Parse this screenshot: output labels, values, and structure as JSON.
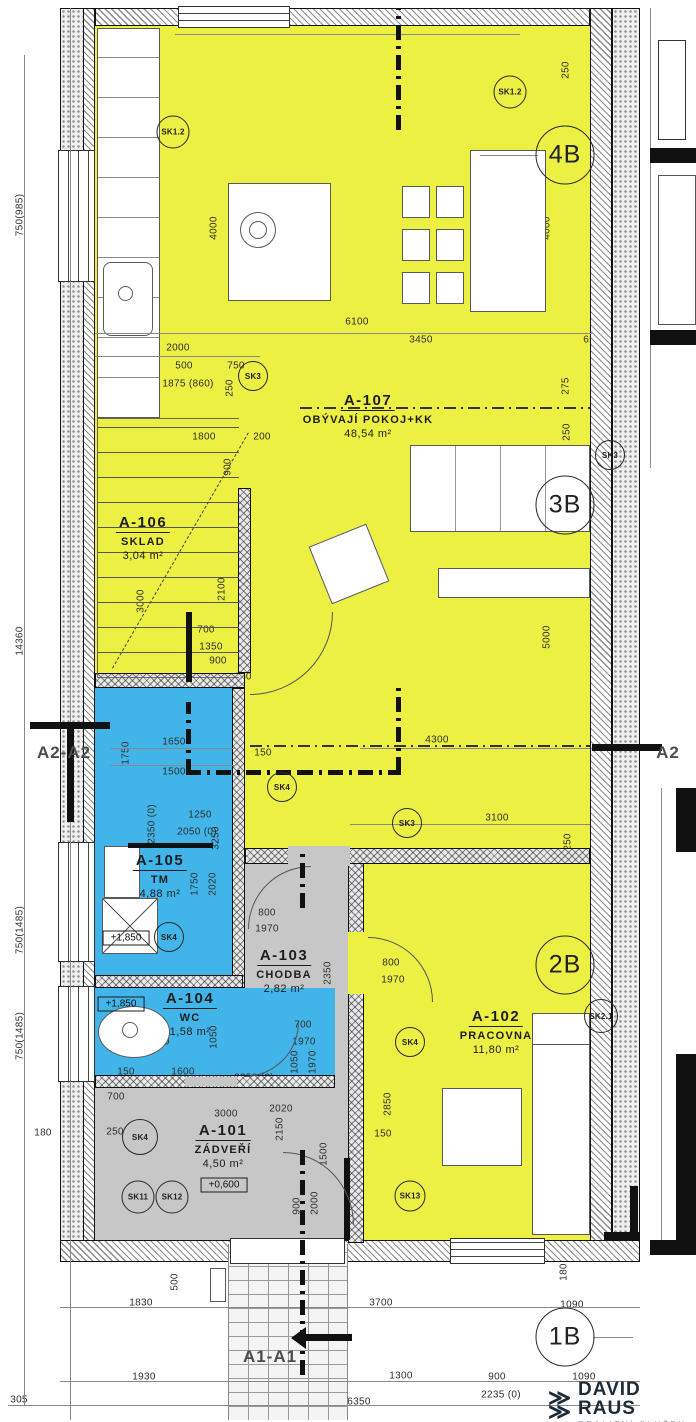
{
  "palette": {
    "room_yellow": "#ebf043",
    "room_blue": "#41b4e9",
    "room_gray": "#c7c7c7",
    "wall_dark": "#111111",
    "dim_text": "#2e2e2e",
    "logo_dark": "#1d2b36",
    "logo_gray": "#93a1ab"
  },
  "rooms": [
    {
      "code": "A-107",
      "name": "OBÝVAJÍ POKOJ+KK",
      "area": "48,54 m²",
      "x": 368,
      "y": 392
    },
    {
      "code": "A-106",
      "name": "SKLAD",
      "area": "3,04 m²",
      "x": 143,
      "y": 514
    },
    {
      "code": "A-105",
      "name": "TM",
      "area": "4,88 m²",
      "x": 160,
      "y": 852
    },
    {
      "code": "A-104",
      "name": "WC",
      "area": "1,58 m²",
      "x": 190,
      "y": 990
    },
    {
      "code": "A-103",
      "name": "CHODBA",
      "area": "2,82 m²",
      "x": 284,
      "y": 947
    },
    {
      "code": "A-102",
      "name": "PRACOVNA",
      "area": "11,80 m²",
      "x": 496,
      "y": 1008
    },
    {
      "code": "A-101",
      "name": "ZÁDVEŘÍ",
      "area": "4,50 m²",
      "x": 223,
      "y": 1122
    }
  ],
  "unit_markers": [
    {
      "label": "4B",
      "x": 565,
      "y": 155
    },
    {
      "label": "3B",
      "x": 565,
      "y": 505
    },
    {
      "label": "2B",
      "x": 565,
      "y": 965
    },
    {
      "label": "1B",
      "x": 565,
      "y": 1337
    }
  ],
  "sk_markers": [
    {
      "label": "SK1.2",
      "x": 173,
      "y": 132,
      "d": 31
    },
    {
      "label": "SK1.2",
      "x": 510,
      "y": 92,
      "d": 31
    },
    {
      "label": "SK3",
      "x": 253,
      "y": 376,
      "d": 28
    },
    {
      "label": "SK3",
      "x": 610,
      "y": 455,
      "d": 28
    },
    {
      "label": "SK3",
      "x": 407,
      "y": 823,
      "d": 28
    },
    {
      "label": "SK4",
      "x": 282,
      "y": 787,
      "d": 28
    },
    {
      "label": "SK4",
      "x": 169,
      "y": 937,
      "d": 28
    },
    {
      "label": "SK4",
      "x": 410,
      "y": 1042,
      "d": 28
    },
    {
      "label": "SK4",
      "x": 140,
      "y": 1137,
      "d": 34
    },
    {
      "label": "SK11",
      "x": 138,
      "y": 1197,
      "d": 31
    },
    {
      "label": "SK12",
      "x": 172,
      "y": 1197,
      "d": 31
    },
    {
      "label": "SK13",
      "x": 410,
      "y": 1196,
      "d": 29
    },
    {
      "label": "SK2.1",
      "x": 601,
      "y": 1016,
      "d": 32
    }
  ],
  "elevations": [
    {
      "text": "+1,850",
      "x": 126,
      "y": 938
    },
    {
      "text": "+1,850",
      "x": 121,
      "y": 1004
    },
    {
      "text": "+0,600",
      "x": 224,
      "y": 1185
    }
  ],
  "sections": [
    {
      "text": "A2-A2",
      "x": 64,
      "y": 753
    },
    {
      "text": "A2",
      "x": 668,
      "y": 753
    },
    {
      "text": "A1-A1",
      "x": 270,
      "y": 1357
    }
  ],
  "logo": {
    "glyph": "≫",
    "name": "DAVID RAUS",
    "subtitle": "REALITNÍ SLUŽBY"
  },
  "dimensions": [
    {
      "t": "250",
      "x": 566,
      "y": 70,
      "r": 90
    },
    {
      "t": "1400 (600)",
      "x": 112,
      "y": 163,
      "r": 90
    },
    {
      "t": "4000",
      "x": 214,
      "y": 228,
      "r": 90
    },
    {
      "t": "4000",
      "x": 547,
      "y": 228,
      "r": 90
    },
    {
      "t": "6100",
      "x": 357,
      "y": 322,
      "r": 0
    },
    {
      "t": "2000",
      "x": 178,
      "y": 348,
      "r": 0
    },
    {
      "t": "750",
      "x": 122,
      "y": 366,
      "r": 0
    },
    {
      "t": "500",
      "x": 184,
      "y": 366,
      "r": 0
    },
    {
      "t": "750",
      "x": 236,
      "y": 366,
      "r": 0
    },
    {
      "t": "1875 (860)",
      "x": 188,
      "y": 384,
      "r": 0
    },
    {
      "t": "250",
      "x": 230,
      "y": 388,
      "r": 90
    },
    {
      "t": "3450",
      "x": 421,
      "y": 340,
      "r": 0
    },
    {
      "t": "650",
      "x": 592,
      "y": 340,
      "r": 0
    },
    {
      "t": "425",
      "x": 608,
      "y": 358,
      "r": 0
    },
    {
      "t": "275",
      "x": 566,
      "y": 386,
      "r": 90
    },
    {
      "t": "250",
      "x": 567,
      "y": 432,
      "r": 90
    },
    {
      "t": "1800",
      "x": 204,
      "y": 437,
      "r": 0
    },
    {
      "t": "200",
      "x": 262,
      "y": 437,
      "r": 0
    },
    {
      "t": "900",
      "x": 228,
      "y": 467,
      "r": 90
    },
    {
      "t": "3000",
      "x": 141,
      "y": 601,
      "r": 90
    },
    {
      "t": "2100",
      "x": 222,
      "y": 589,
      "r": 90
    },
    {
      "t": "700",
      "x": 206,
      "y": 630,
      "r": 0
    },
    {
      "t": "1350",
      "x": 211,
      "y": 647,
      "r": 0
    },
    {
      "t": "900",
      "x": 218,
      "y": 661,
      "r": 0
    },
    {
      "t": "750",
      "x": 130,
      "y": 683,
      "r": 0
    },
    {
      "t": "150",
      "x": 243,
      "y": 677,
      "r": 0
    },
    {
      "t": "5000",
      "x": 547,
      "y": 637,
      "r": 90
    },
    {
      "t": "4300",
      "x": 437,
      "y": 740,
      "r": 0
    },
    {
      "t": "150",
      "x": 263,
      "y": 753,
      "r": 0
    },
    {
      "t": "250",
      "x": 601,
      "y": 753,
      "r": 0
    },
    {
      "t": "20",
      "x": 631,
      "y": 757,
      "r": 0
    },
    {
      "t": "1650",
      "x": 174,
      "y": 742,
      "r": 0
    },
    {
      "t": "1500",
      "x": 174,
      "y": 772,
      "r": 0
    },
    {
      "t": "1750",
      "x": 126,
      "y": 753,
      "r": 90
    },
    {
      "t": "1250",
      "x": 200,
      "y": 815,
      "r": 0
    },
    {
      "t": "2050 (0)",
      "x": 197,
      "y": 832,
      "r": 0
    },
    {
      "t": "3100",
      "x": 497,
      "y": 818,
      "r": 0
    },
    {
      "t": "250",
      "x": 568,
      "y": 842,
      "r": 90
    },
    {
      "t": "2350 (0)",
      "x": 152,
      "y": 824,
      "r": 90
    },
    {
      "t": "3250",
      "x": 216,
      "y": 838,
      "r": 90
    },
    {
      "t": "1750",
      "x": 195,
      "y": 884,
      "r": 90
    },
    {
      "t": "2020",
      "x": 213,
      "y": 884,
      "r": 90
    },
    {
      "t": "1500",
      "x": 129,
      "y": 908,
      "r": 90
    },
    {
      "t": "800",
      "x": 267,
      "y": 913,
      "r": 0
    },
    {
      "t": "1970",
      "x": 267,
      "y": 929,
      "r": 0
    },
    {
      "t": "2350",
      "x": 328,
      "y": 973,
      "r": 90
    },
    {
      "t": "800",
      "x": 391,
      "y": 963,
      "r": 0
    },
    {
      "t": "1970",
      "x": 393,
      "y": 980,
      "r": 0
    },
    {
      "t": "700",
      "x": 303,
      "y": 1025,
      "r": 0
    },
    {
      "t": "1970",
      "x": 304,
      "y": 1042,
      "r": 0
    },
    {
      "t": "1050",
      "x": 295,
      "y": 1062,
      "r": 90
    },
    {
      "t": "1970",
      "x": 313,
      "y": 1062,
      "r": 90
    },
    {
      "t": "1750",
      "x": 158,
      "y": 1042,
      "r": 0
    },
    {
      "t": "1050",
      "x": 214,
      "y": 1037,
      "r": 90
    },
    {
      "t": "150",
      "x": 126,
      "y": 1072,
      "r": 0
    },
    {
      "t": "1600",
      "x": 183,
      "y": 1072,
      "r": 0
    },
    {
      "t": "2350 (0)",
      "x": 254,
      "y": 1078,
      "r": 0
    },
    {
      "t": "700",
      "x": 116,
      "y": 1097,
      "r": 0
    },
    {
      "t": "3000",
      "x": 226,
      "y": 1114,
      "r": 0
    },
    {
      "t": "2020",
      "x": 281,
      "y": 1109,
      "r": 0
    },
    {
      "t": "2150",
      "x": 280,
      "y": 1129,
      "r": 90
    },
    {
      "t": "1500",
      "x": 324,
      "y": 1154,
      "r": 90
    },
    {
      "t": "250",
      "x": 115,
      "y": 1132,
      "r": 0
    },
    {
      "t": "900",
      "x": 297,
      "y": 1206,
      "r": 90
    },
    {
      "t": "2000",
      "x": 315,
      "y": 1203,
      "r": 90
    },
    {
      "t": "2850",
      "x": 388,
      "y": 1104,
      "r": 90
    },
    {
      "t": "150",
      "x": 383,
      "y": 1134,
      "r": 0
    },
    {
      "t": "2950",
      "x": 492,
      "y": 1110,
      "r": 0
    },
    {
      "t": "4000",
      "x": 546,
      "y": 1045,
      "r": 90
    },
    {
      "t": "750(985)",
      "x": 20,
      "y": 215,
      "r": 90
    },
    {
      "t": "14360",
      "x": 20,
      "y": 641,
      "r": 90
    },
    {
      "t": "750(1485)",
      "x": 20,
      "y": 930,
      "r": 90
    },
    {
      "t": "750(1485)",
      "x": 20,
      "y": 1036,
      "r": 90
    },
    {
      "t": "180",
      "x": 43,
      "y": 1133,
      "r": 0
    },
    {
      "t": "500",
      "x": 175,
      "y": 1282,
      "r": 90
    },
    {
      "t": "1830",
      "x": 141,
      "y": 1303,
      "r": 0
    },
    {
      "t": "3700",
      "x": 381,
      "y": 1303,
      "r": 0
    },
    {
      "t": "1090",
      "x": 572,
      "y": 1305,
      "r": 0
    },
    {
      "t": "180",
      "x": 564,
      "y": 1272,
      "r": 90
    },
    {
      "t": "1930",
      "x": 144,
      "y": 1377,
      "r": 0
    },
    {
      "t": "1400",
      "x": 285,
      "y": 1379,
      "r": 0
    },
    {
      "t": "1300",
      "x": 401,
      "y": 1376,
      "r": 0
    },
    {
      "t": "900",
      "x": 497,
      "y": 1377,
      "r": 0
    },
    {
      "t": "1090",
      "x": 584,
      "y": 1377,
      "r": 0
    },
    {
      "t": "2235 (0)",
      "x": 501,
      "y": 1395,
      "r": 0
    },
    {
      "t": "2100 (0)",
      "x": 289,
      "y": 1395,
      "r": 0
    },
    {
      "t": "6350",
      "x": 359,
      "y": 1402,
      "r": 0
    },
    {
      "t": "305",
      "x": 19,
      "y": 1400,
      "r": 0
    }
  ]
}
